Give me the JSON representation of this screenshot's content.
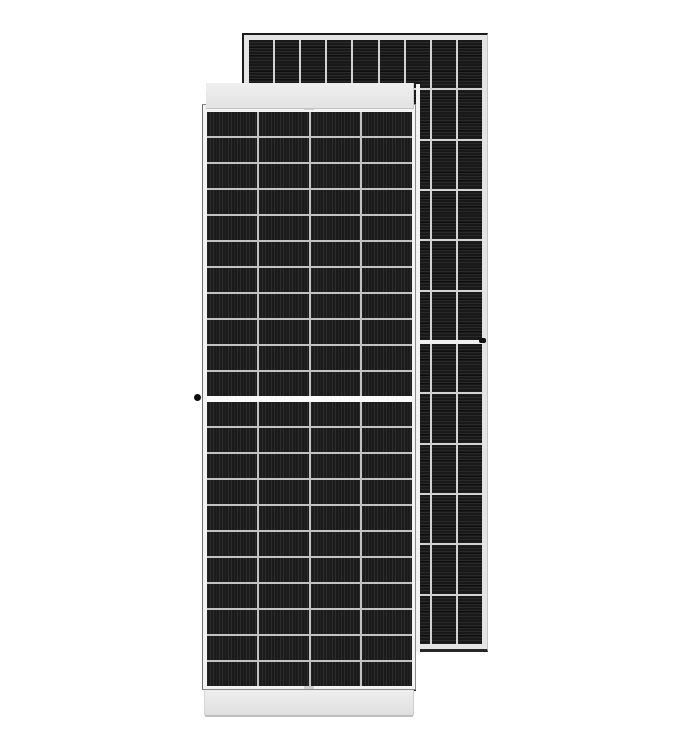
{
  "scene": {
    "background_color": "#ffffff",
    "subject": "two framed monocrystalline solar panels, front and rear"
  },
  "back_panel": {
    "label": "rear solar panel",
    "columns": 9,
    "rows_per_half": 6,
    "halves": 2,
    "stripe_direction": "horizontal",
    "cell_color": "#191919",
    "grid_line_color": "#d2d2d2",
    "mid_gap_color": "#f0f0f0",
    "frame_color": "#e4e4e4",
    "outline_color": "#1c1c1c",
    "grounding_dot_color": "#111111"
  },
  "front_panel": {
    "label": "front solar panel",
    "columns": 4,
    "rows_per_half": 11,
    "halves": 2,
    "stripe_direction": "vertical",
    "cell_color": "#1b1b1b",
    "grid_line_color": "#c2c2c2",
    "mid_gap_color": "#fafafa",
    "frame_color": "#f3f3f3",
    "outline_color": "#8a8a8a",
    "top_bar_color": "#e7e7e7",
    "bottom_bar_color": "#e7e7e7",
    "grounding_dot_color": "#0d0d0d"
  }
}
